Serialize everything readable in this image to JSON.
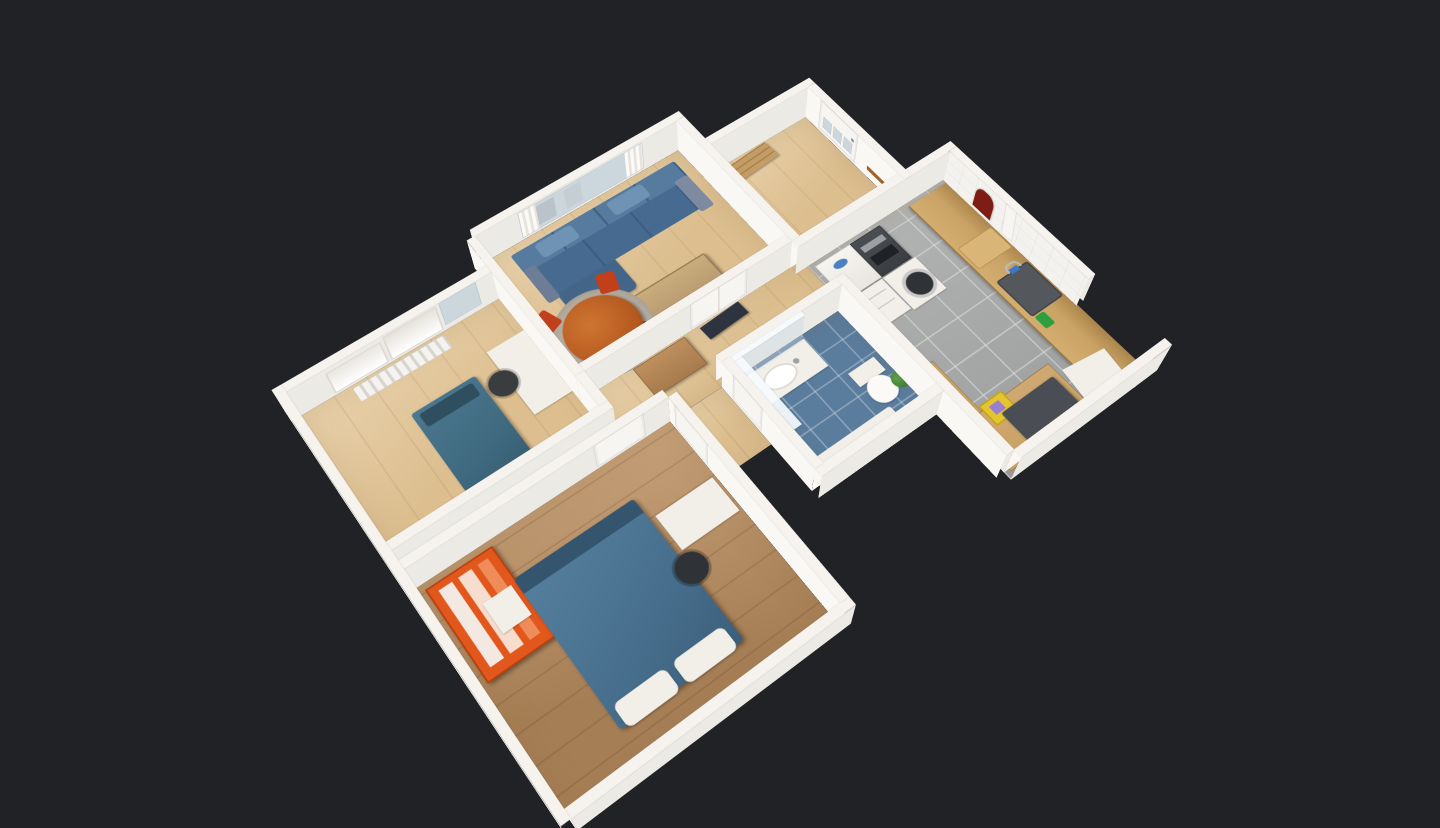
{
  "viewer": {
    "mode": "dollhouse-3d",
    "description": "Top-down dollhouse view of a 3D-scanned furnished apartment floating on a dark canvas",
    "background": "#202225"
  },
  "colors": {
    "bg": "#202225",
    "wallTop": "#f6f3ef",
    "wallBright": "#faf8f5",
    "wallShade": "#eceae5",
    "floorOak": "#dcbe8f",
    "floorDark": "#b4895c",
    "tileBlue": "#5a7c9d",
    "tileGray": "#a7a9a8",
    "fixtureWhite": "#f2efe9",
    "glassBlue": "#ccd7dd",
    "sofaBlue": "#476b90",
    "sofaBack": "#567b9f",
    "bedTeal": "#3f6a80",
    "bedBlue": "#49718f",
    "tableWood": "#c9ad7e",
    "diningWood": "#b55a20",
    "chairRed": "#c23f1c",
    "wardrobeOrange": "#e2571c",
    "counterWood": "#c9a265",
    "sinkGray": "#54585c",
    "towelRed": "#7e1d14",
    "plantGreen": "#3e7a34",
    "rugGray": "#b7aea1",
    "cabinetBrown": "#a87b4e",
    "applianceDark": "#3a3d41",
    "accentYellow": "#e4c52e",
    "accentPurple": "#9a7fd0"
  },
  "rooms": [
    {
      "id": "living-room",
      "label": "Living room",
      "furniture": [
        "blue sectional sofa",
        "wooden coffee table",
        "round dining table",
        "red dining chairs",
        "round rug",
        "window curtains",
        "TV panel"
      ]
    },
    {
      "id": "small-bedroom",
      "label": "Small bedroom",
      "furniture": [
        "single bed with teal cover",
        "white desk",
        "desk chair",
        "roman blinds window",
        "radiator"
      ]
    },
    {
      "id": "master-bedroom",
      "label": "Master bedroom",
      "furniture": [
        "double bed with blue cover",
        "orange open wardrobe",
        "bedside table",
        "white desk",
        "black chair",
        "three framed prints"
      ]
    },
    {
      "id": "bathroom",
      "label": "Bathroom",
      "furniture": [
        "white vanity with sink",
        "toilet",
        "glass shower screen",
        "plant",
        "blue floor tiles"
      ]
    },
    {
      "id": "kitchen",
      "label": "Kitchen",
      "furniture": [
        "fridge",
        "oven column",
        "washing machine",
        "drawer unit",
        "wooden countertop",
        "sink with faucet",
        "red towel",
        "ironing board",
        "stool table",
        "yellow cabinet"
      ]
    },
    {
      "id": "entry-hall",
      "label": "Entry hall",
      "furniture": [
        "glazed entry door",
        "coat rack",
        "radiator",
        "folded table"
      ]
    },
    {
      "id": "hallway",
      "label": "Hallway",
      "furniture": [
        "brown cabinet",
        "white interior doors"
      ]
    }
  ]
}
